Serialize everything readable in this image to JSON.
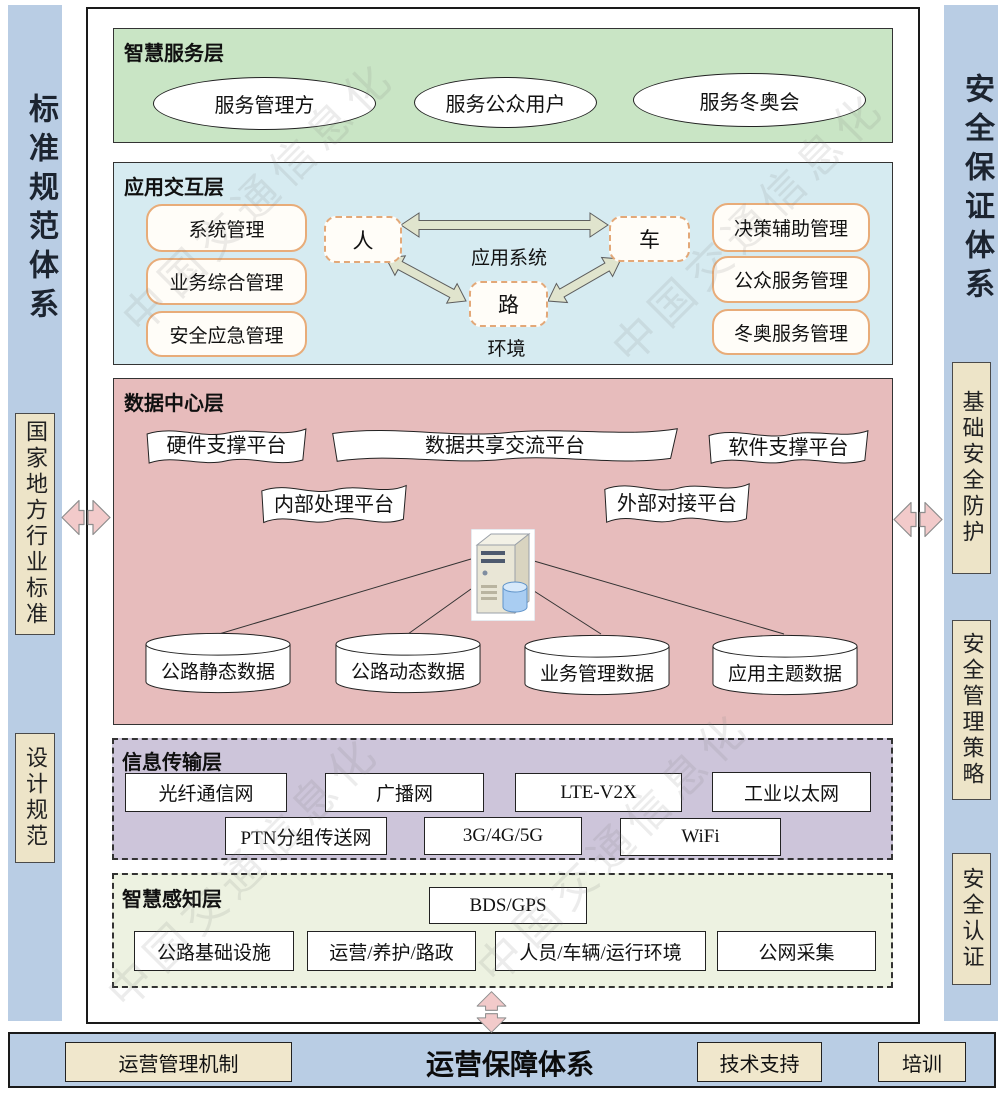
{
  "watermark": {
    "text": "中国交通信息化",
    "logo": "◎"
  },
  "left_sidebar": {
    "title": "标准规范体系",
    "items": [
      "国家地方行业标准",
      "设计规范"
    ]
  },
  "right_sidebar": {
    "title": "安全保证体系",
    "items": [
      "基础安全防护",
      "安全管理策略",
      "安全认证"
    ]
  },
  "layers": {
    "service": {
      "label": "智慧服务层",
      "ellipses": [
        "服务管理方",
        "服务公众用户",
        "服务冬奥会"
      ]
    },
    "application": {
      "label": "应用交互层",
      "left_items": [
        "系统管理",
        "业务综合管理",
        "安全应急管理"
      ],
      "right_items": [
        "决策辅助管理",
        "公众服务管理",
        "冬奥服务管理"
      ],
      "node_person": "人",
      "node_vehicle": "车",
      "node_road": "路",
      "center_label": "应用系统",
      "bottom_label": "环境"
    },
    "data_center": {
      "label": "数据中心层",
      "banners": [
        "硬件支撑平台",
        "数据共享交流平台",
        "软件支撑平台",
        "内部处理平台",
        "外部对接平台"
      ],
      "cylinders": [
        "公路静态数据",
        "公路动态数据",
        "业务管理数据",
        "应用主题数据"
      ]
    },
    "transmission": {
      "label": "信息传输层",
      "row1": [
        "光纤通信网",
        "广播网",
        "LTE-V2X",
        "工业以太网"
      ],
      "row2": [
        "PTN分组传送网",
        "3G/4G/5G",
        "WiFi"
      ]
    },
    "perception": {
      "label": "智慧感知层",
      "gnss": "BDS/GPS",
      "row": [
        "公路基础设施",
        "运营/养护/路政",
        "人员/车辆/运行环境",
        "公网采集"
      ]
    }
  },
  "bottom_bar": {
    "title": "运营保障体系",
    "items": [
      "运营管理机制",
      "技术支持",
      "培训"
    ]
  },
  "colors": {
    "sidebar_bg": "#b9cde4",
    "tan_box": "#ede4c8",
    "service_layer": "#c9e5c5",
    "application_layer": "#d6ebf1",
    "data_layer": "#e7bcbc",
    "transmission_layer": "#cdc5da",
    "perception_layer": "#edf2e1",
    "bottom_bar": "#b9cde4",
    "accent_orange": "#e8ac79",
    "connector_pink": "#f2caca",
    "arrow_olive": "#e0e4cd"
  }
}
